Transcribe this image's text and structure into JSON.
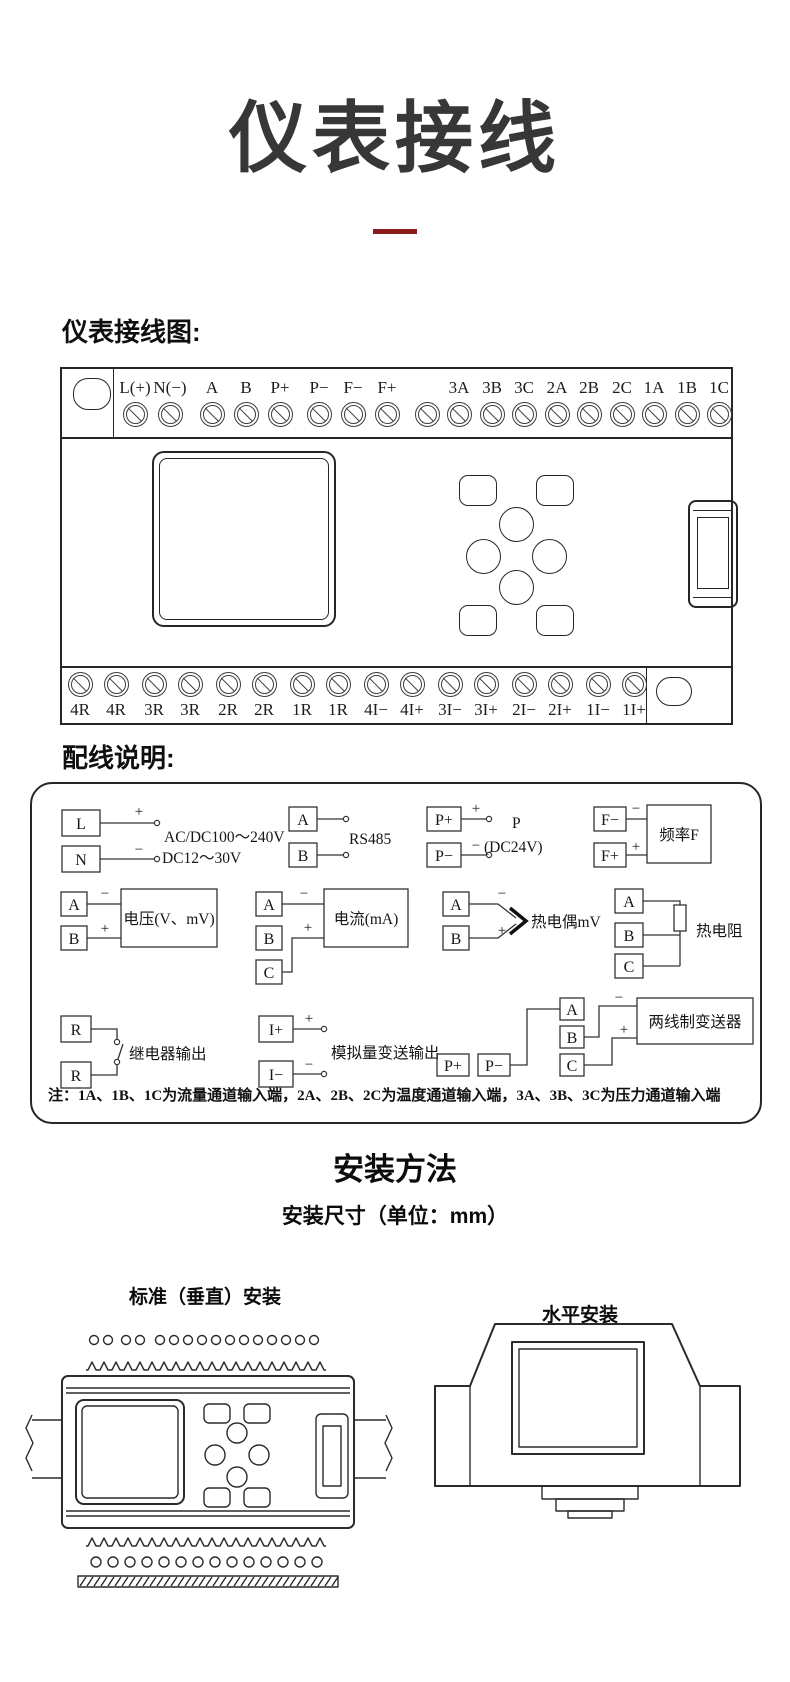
{
  "page": {
    "title": "仪表接线",
    "wiring_diagram_heading": "仪表接线图:",
    "wiring_notes_heading": "配线说明:",
    "install": {
      "title": "安装方法",
      "subtitle": "安装尺寸（单位：mm）",
      "vertical_label": "标准（垂直）安装",
      "horizontal_label": "水平安装"
    }
  },
  "terminal_block": {
    "top_groups": [
      [
        "L(+)",
        "N(−)"
      ],
      [
        "A",
        "B",
        "P+"
      ],
      [
        "P−",
        "F−",
        "F+"
      ],
      [
        "",
        "3A",
        "3B",
        "3C",
        "2A",
        "2B",
        "2C",
        "1A",
        "1B",
        "1C"
      ]
    ],
    "bottom_groups": [
      [
        "4R",
        "4R"
      ],
      [
        "3R",
        "3R"
      ],
      [
        "2R",
        "2R"
      ],
      [
        "1R",
        "1R"
      ],
      [
        "4I−",
        "4I+"
      ],
      [
        "3I−",
        "3I+"
      ],
      [
        "2I−",
        "2I+"
      ],
      [
        "1I−",
        "1I+"
      ]
    ]
  },
  "wiring_diagrams": {
    "signs": {
      "plus": "+",
      "minus": "−"
    },
    "power": {
      "terminals": [
        "L",
        "N"
      ],
      "line1": "AC/DC100～240V",
      "line2": "DC12～30V"
    },
    "rs485": {
      "terminals": [
        "A",
        "B"
      ],
      "label": "RS485"
    },
    "dc24": {
      "terminals": [
        "P+",
        "P−"
      ],
      "line1": "P",
      "line2": "(DC24V)"
    },
    "freq": {
      "terminals": [
        "F−",
        "F+"
      ],
      "device": "频率F"
    },
    "voltage": {
      "terminals": [
        "A",
        "B"
      ],
      "device": "电压(V、mV)"
    },
    "current": {
      "terminals": [
        "A",
        "B",
        "C"
      ],
      "device": "电流(mA)"
    },
    "thermocouple": {
      "terminals": [
        "A",
        "B"
      ],
      "label": "热电偶mV"
    },
    "rtd": {
      "terminals": [
        "A",
        "B",
        "C"
      ],
      "label": "热电阻"
    },
    "relay": {
      "terminals": [
        "R",
        "R"
      ],
      "label": "继电器输出"
    },
    "analog_out": {
      "terminals": [
        "I+",
        "I−"
      ],
      "label": "模拟量变送输出"
    },
    "transmitter": {
      "terminals": [
        "A",
        "B",
        "C",
        "P+",
        "P−"
      ],
      "device": "两线制变送器"
    },
    "note": "注：1A、1B、1C为流量通道输入端，2A、2B、2C为温度通道输入端，3A、3B、3C为压力通道输入端"
  },
  "colors": {
    "underline_red": "#8b1b1b",
    "title_gray": "#373737",
    "line_dark": "#262626"
  }
}
